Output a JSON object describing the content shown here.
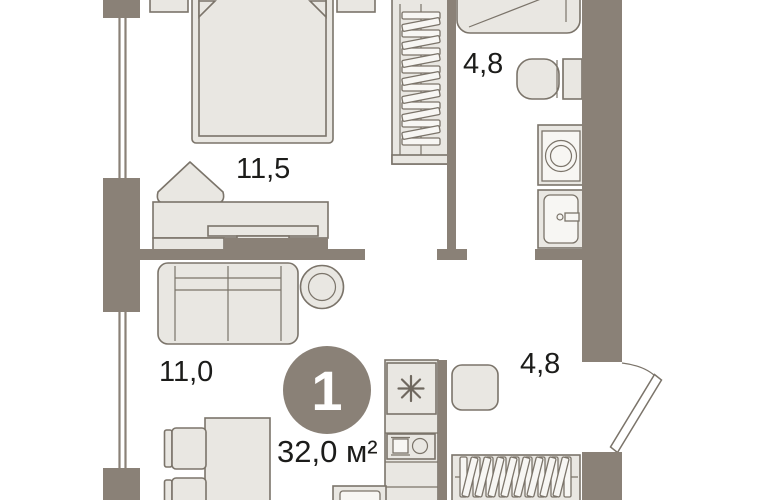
{
  "plan": {
    "badge": {
      "rooms_count": "1"
    },
    "total_area": "32,0 м²",
    "rooms": [
      {
        "id": "bedroom",
        "area_label": "11,5"
      },
      {
        "id": "bathroom",
        "area_label": "4,8"
      },
      {
        "id": "living-room",
        "area_label": "11,0"
      },
      {
        "id": "hallway",
        "area_label": "4,8"
      }
    ],
    "colors": {
      "wall": "#8a8177",
      "furniture_fill": "#e9e7e2",
      "furniture_stroke": "#7b746a",
      "background": "#ffffff",
      "badge_fill": "#8a8177",
      "badge_text": "#ffffff",
      "text": "#1c1c1a"
    },
    "furniture": [
      "bed",
      "nightstand",
      "pouf",
      "desk",
      "tv",
      "wardrobe-hangers",
      "shower",
      "toilet",
      "washing-machine",
      "bathroom-sink",
      "sofa",
      "plant",
      "dining-table",
      "chair",
      "kitchen-stove",
      "kitchen-sink",
      "oven",
      "stool",
      "entrance-door"
    ]
  }
}
